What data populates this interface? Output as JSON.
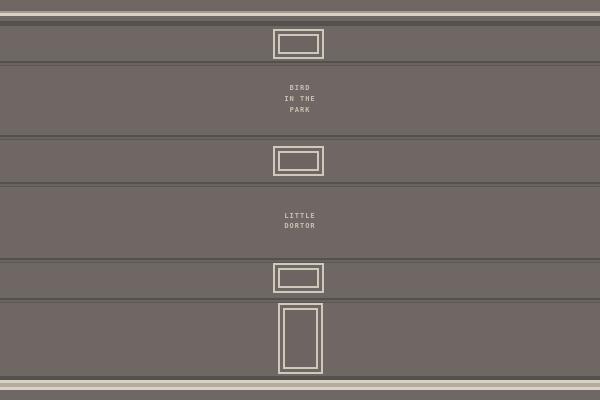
{
  "scene": {
    "description": "building-facade-with-signs",
    "signs": {
      "bird_in_the_park": {
        "lines": [
          "BIRD",
          "IN THE",
          "PARK"
        ]
      },
      "little_dortor": {
        "lines": [
          "LITTLE",
          "DORTOR"
        ]
      }
    },
    "colors": {
      "wall": "#6f6764",
      "wall-dark": "#56504d",
      "groove-mid": "#6a6360",
      "trim-cream": "#d8d2c4",
      "trim-gray": "#a49c91",
      "trim-tan": "#b5ac9f",
      "frame-cream": "#cfc9bb",
      "window-fill": "#6c6561",
      "sign-text": "#c7c0b2"
    }
  }
}
